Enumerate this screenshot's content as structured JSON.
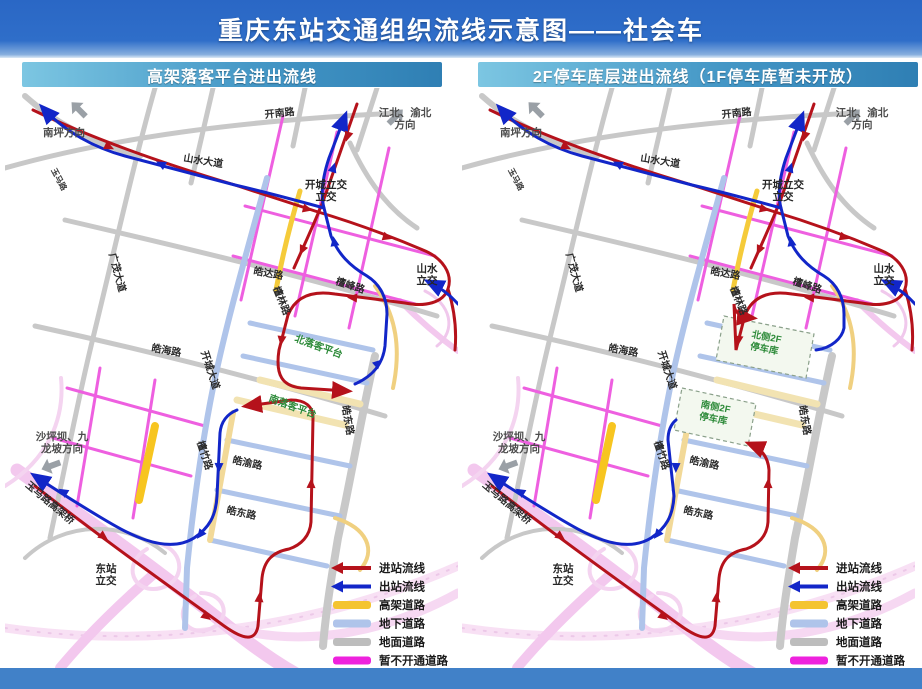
{
  "title": "重庆东站交通组织流线示意图——社会车",
  "panels": [
    {
      "id": "left",
      "header": "高架落客平台进出流线"
    },
    {
      "id": "right",
      "header": "2F停车库层进出流线（1F停车库暂未开放）"
    }
  ],
  "legend": [
    {
      "label": "进站流线",
      "type": "arrow",
      "color": "#b5121b"
    },
    {
      "label": "出站流线",
      "type": "arrow",
      "color": "#1226c8"
    },
    {
      "label": "高架道路",
      "type": "bar",
      "color": "#f4c430"
    },
    {
      "label": "地下道路",
      "type": "bar",
      "color": "#afc4ea"
    },
    {
      "label": "地面道路",
      "type": "bar",
      "color": "#bdbdbd"
    },
    {
      "label": "暂不开通道路",
      "type": "bar",
      "color": "#ee22dd"
    }
  ],
  "map_labels": {
    "shared": [
      {
        "text": "南坪方向",
        "x": 38,
        "y": 48,
        "rot": 0,
        "kind": "dir"
      },
      {
        "text": "玉马路",
        "x": 46,
        "y": 82,
        "rot": 62,
        "kind": "road-sm"
      },
      {
        "text": "山水大道",
        "x": 178,
        "y": 73,
        "rot": 9,
        "kind": "road"
      },
      {
        "text": "开南路",
        "x": 260,
        "y": 30,
        "rot": -6,
        "kind": "road"
      },
      {
        "lines": [
          "江北、渝北",
          "方向"
        ],
        "x": 400,
        "y": 28,
        "rot": 0,
        "kind": "dir"
      },
      {
        "lines": [
          "开城立交",
          "立交"
        ],
        "x": 321,
        "y": 100,
        "rot": 0,
        "kind": "ic",
        "two": [
          "开城",
          "立交"
        ]
      },
      {
        "text": "广茂大道",
        "x": 104,
        "y": 166,
        "rot": 75,
        "kind": "road"
      },
      {
        "text": "皓达路",
        "x": 248,
        "y": 186,
        "rot": 10,
        "kind": "road"
      },
      {
        "text": "檀林路",
        "x": 268,
        "y": 200,
        "rot": 68,
        "kind": "road"
      },
      {
        "text": "檀峰路",
        "x": 330,
        "y": 196,
        "rot": 18,
        "kind": "road"
      },
      {
        "lines": [
          "山水",
          "立交"
        ],
        "x": 422,
        "y": 184,
        "rot": 0,
        "kind": "ic"
      },
      {
        "text": "开城大道",
        "x": 196,
        "y": 264,
        "rot": 72,
        "kind": "road"
      },
      {
        "text": "皓海路",
        "x": 146,
        "y": 263,
        "rot": 10,
        "kind": "road"
      },
      {
        "text": "皓东路",
        "x": 337,
        "y": 318,
        "rot": 80,
        "kind": "road"
      },
      {
        "text": "檀竹路",
        "x": 192,
        "y": 354,
        "rot": 72,
        "kind": "road"
      },
      {
        "text": "皓渝路",
        "x": 227,
        "y": 375,
        "rot": 12,
        "kind": "road"
      },
      {
        "text": "皓东路",
        "x": 221,
        "y": 425,
        "rot": 12,
        "kind": "road"
      },
      {
        "lines": [
          "沙坪坝、九",
          "龙坡方向"
        ],
        "x": 57,
        "y": 352,
        "rot": 0,
        "kind": "dir"
      },
      {
        "text": "玉马路高架桥",
        "x": 20,
        "y": 398,
        "rot": 40,
        "kind": "road"
      },
      {
        "lines": [
          "东站",
          "立交"
        ],
        "x": 101,
        "y": 484,
        "rot": 0,
        "kind": "ic"
      }
    ],
    "left_only": [
      {
        "text": "北落客平台",
        "x": 289,
        "y": 253,
        "rot": 20,
        "kind": "green"
      },
      {
        "text": "南落客平台",
        "x": 263,
        "y": 313,
        "rot": 20,
        "kind": "green"
      }
    ],
    "right_only": [
      {
        "lines": [
          "北侧2F",
          "停车库"
        ],
        "x": 304,
        "y": 252,
        "rot": 11,
        "kind": "garage"
      },
      {
        "lines": [
          "南侧2F",
          "停车库"
        ],
        "x": 253,
        "y": 322,
        "rot": 11,
        "kind": "garage"
      }
    ]
  },
  "colors": {
    "inbound": "#b5121b",
    "outbound": "#1226c8",
    "elevated": "#f4c430",
    "underground": "#afc4ea",
    "ground": "#c8c8c8",
    "closed": "#ee5fe0",
    "highway_pink": "#f3c8ee",
    "banner_blue": "#2a67c5",
    "footer_blue": "#4181c8"
  }
}
